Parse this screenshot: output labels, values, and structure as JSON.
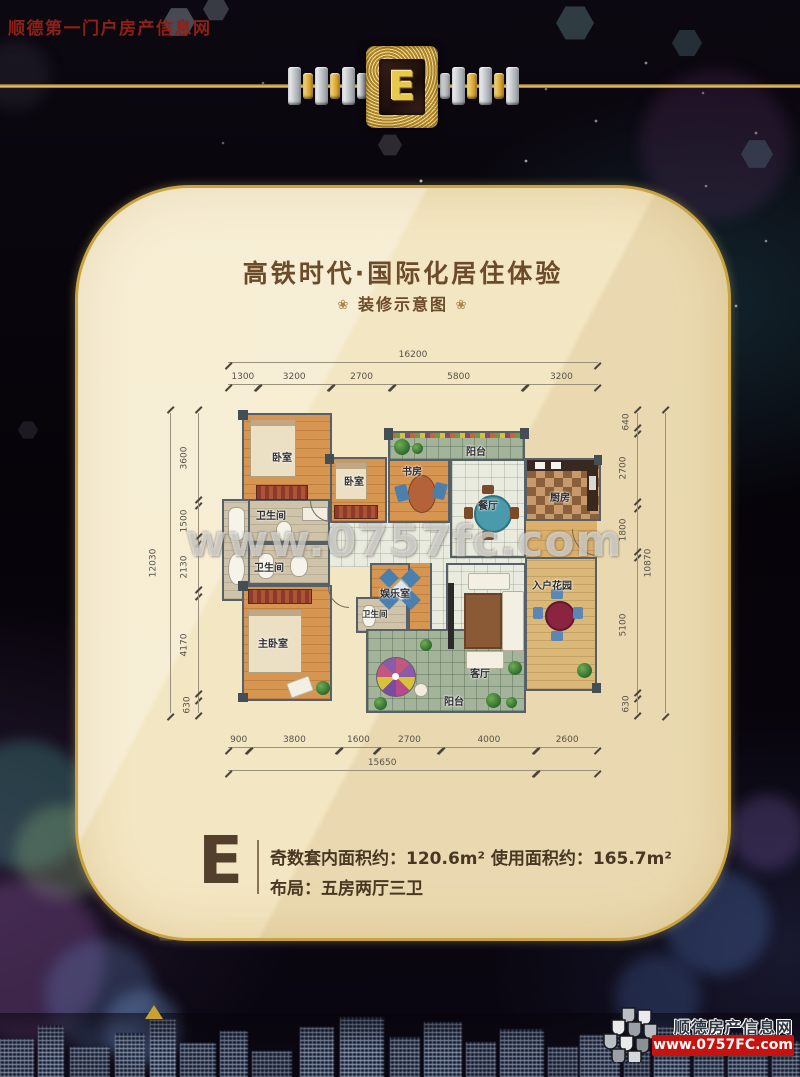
{
  "header": {
    "site_name": "顺德第一门户房产信息网",
    "emblem_letter": "E"
  },
  "card": {
    "title": "高铁时代·国际化居住体验",
    "subtitle": "装修示意图",
    "ornament_left": "❀",
    "ornament_right": "❀",
    "watermark": "www.0757fc.com"
  },
  "floorplan": {
    "dims_top_total": "16200",
    "dims_top": [
      "1300",
      "3200",
      "2700",
      "5800",
      "3200"
    ],
    "dims_left_total": "12030",
    "dims_left": [
      "3600",
      "1500",
      "2130",
      "4170",
      "630"
    ],
    "dims_right": [
      "640",
      "2700",
      "1800",
      "5100",
      "630"
    ],
    "dims_right_total": "10870",
    "dims_bottom": [
      "900",
      "3800",
      "1600",
      "2700",
      "4000",
      "2600"
    ],
    "dims_bottom_total": "15650",
    "rooms": {
      "bedroom1": "卧室",
      "bedroom2": "卧室",
      "study": "书房",
      "balcony_top": "阳台",
      "dining": "餐厅",
      "kitchen": "厨房",
      "bath1": "卫生间",
      "bath2": "卫生间",
      "bath3": "卫生间",
      "master": "主卧室",
      "entertainment": "娱乐室",
      "living": "客厅",
      "garden": "入户花园",
      "balcony_bottom": "阳台"
    }
  },
  "info": {
    "unit_letter": "E",
    "line1": "奇数套内面积约：120.6m² 使用面积约：165.7m²",
    "line2": "布局：五房两厅三卫"
  },
  "footer": {
    "site_name": "顺德房产信息网",
    "url": "www.0757FC.com"
  },
  "colors": {
    "accent_gold": "#c9a43e",
    "card_bg": "#f3e6c2",
    "title_brown": "#6b4b2a",
    "wall_gray": "#566069",
    "wood_floor": "#d69550",
    "banner_red": "#c61310",
    "site_name_red": "#8e2016"
  }
}
